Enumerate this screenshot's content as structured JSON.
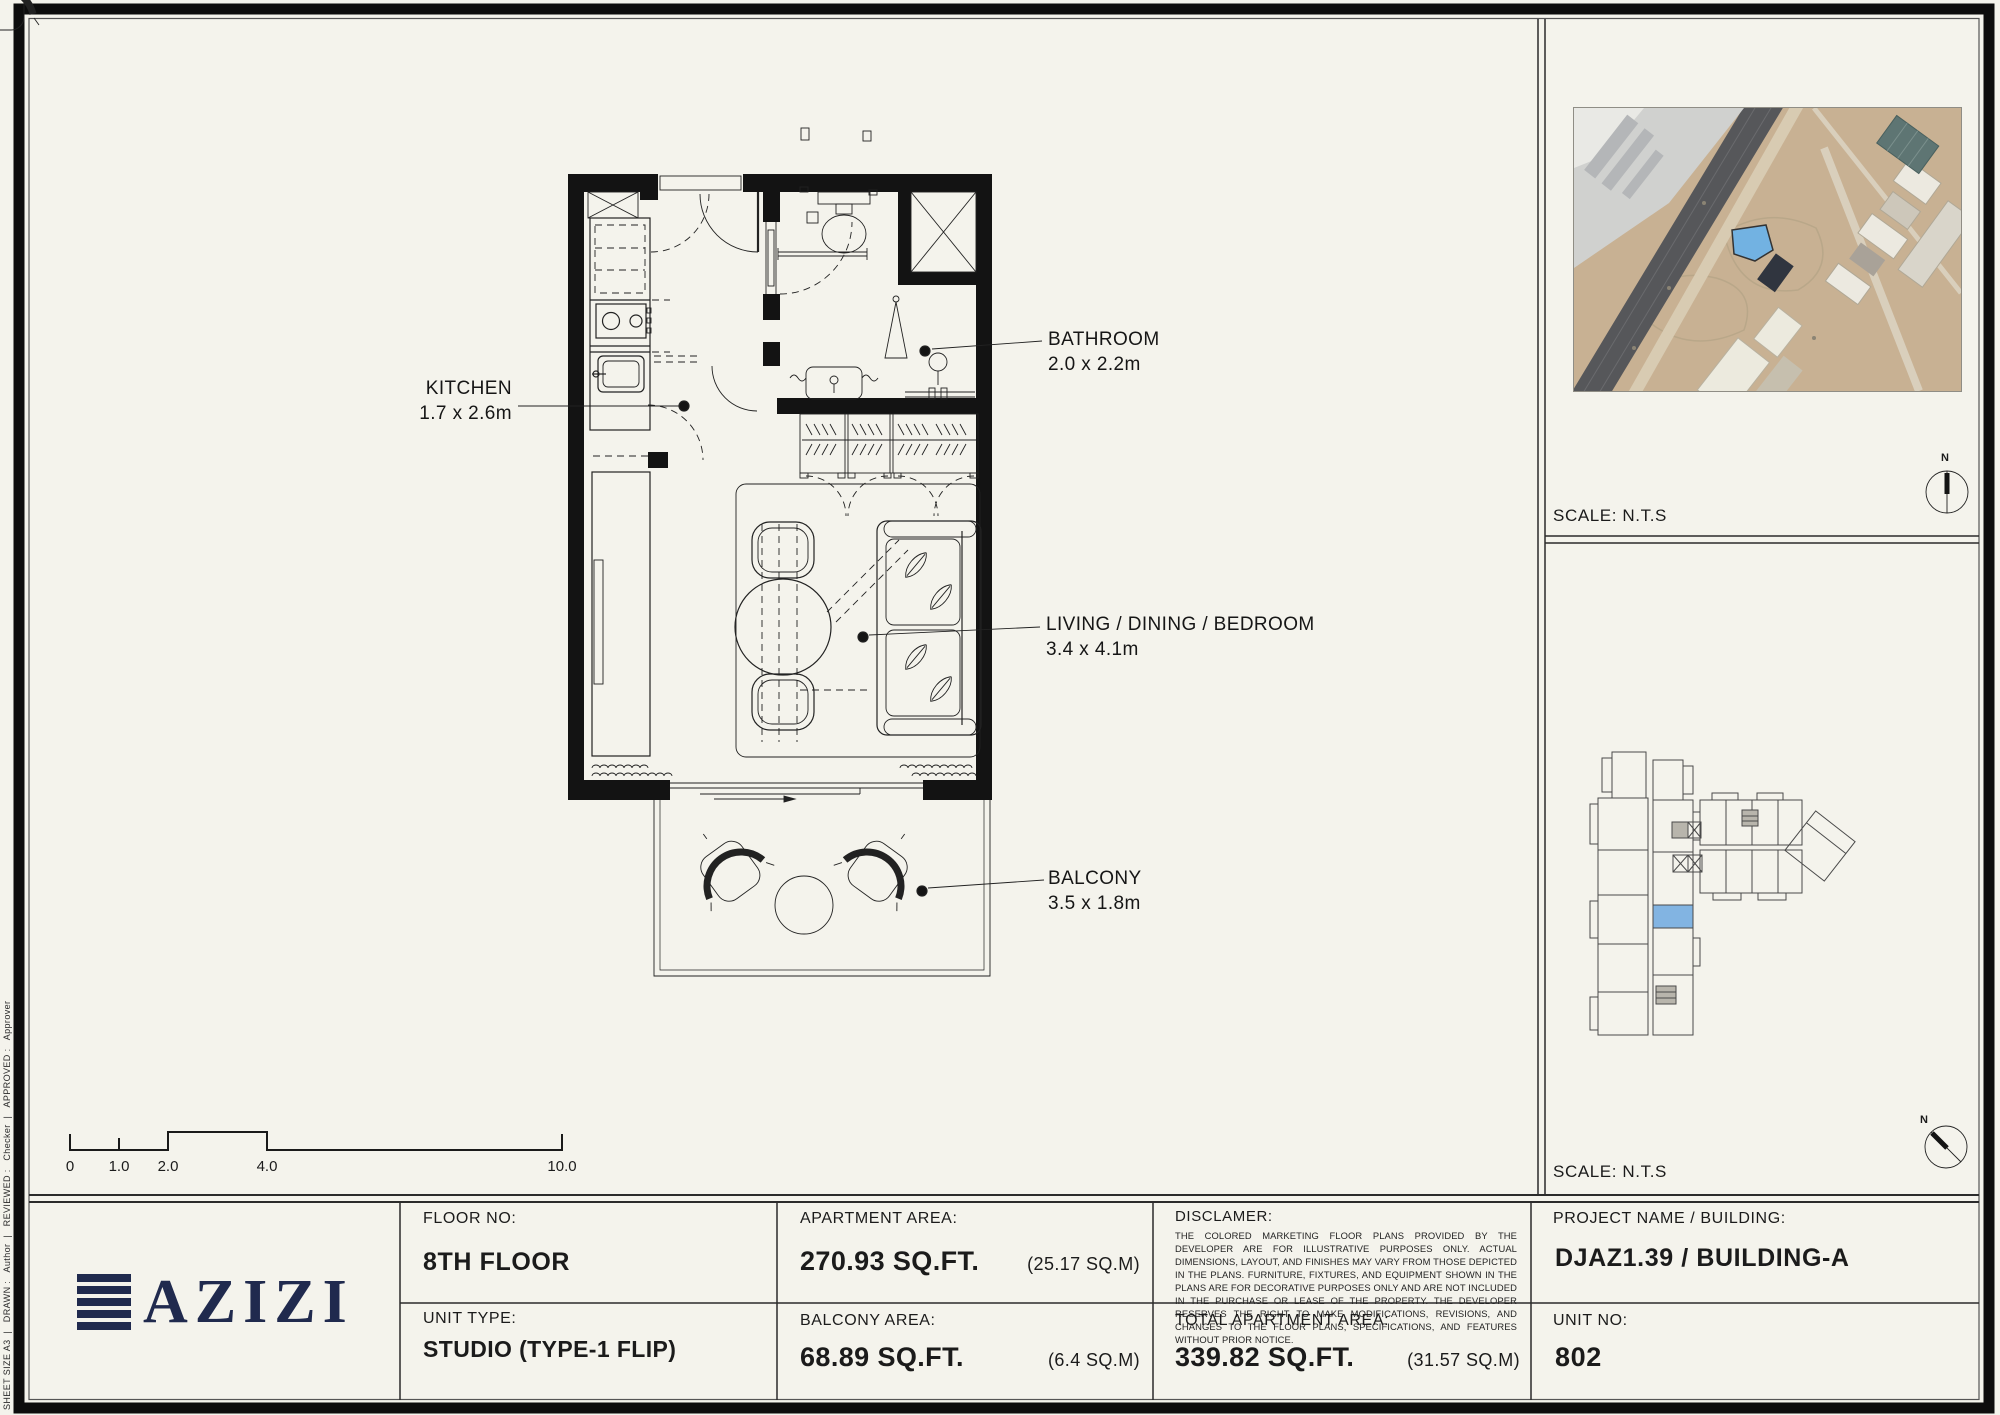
{
  "colors": {
    "paper": "#f4f3ec",
    "ink": "#141414",
    "brand_navy": "#202a4e",
    "unit_highlight_blue": "#82b4e2",
    "site_plot_blue": "#72b2e2"
  },
  "icons": {
    "north_compass": "compass-needle-icon",
    "duct_x": "shaft-x-icon"
  },
  "plan": {
    "rooms": [
      {
        "name": "KITCHEN",
        "dims": "1.7 x 2.6m"
      },
      {
        "name": "BATHROOM",
        "dims": "2.0 x 2.2m"
      },
      {
        "name": "LIVING / DINING / BEDROOM",
        "dims": "3.4 x 4.1m"
      },
      {
        "name": "BALCONY",
        "dims": "3.5 x 1.8m"
      }
    ],
    "scale_bar": {
      "ticks": [
        "0",
        "1.0",
        "2.0",
        "4.0",
        "10.0"
      ]
    }
  },
  "map_panel": {
    "scale_label": "SCALE: N.T.S",
    "north_label": "N"
  },
  "keyplan_panel": {
    "scale_label": "SCALE: N.T.S",
    "north_label": "N"
  },
  "sheet_margin": {
    "sheet_size": "SHEET SIZE A3",
    "drawn_label": "DRAWN :",
    "drawn": "Author",
    "reviewed_label": "REVIEWED :",
    "reviewed": "Checker",
    "approved_label": "APPROVED :",
    "approved": "Approver"
  },
  "title_block": {
    "brand": "AZIZI",
    "floor_label": "FLOOR NO:",
    "floor": "8TH FLOOR",
    "unit_type_label": "UNIT TYPE:",
    "unit_type": "STUDIO (TYPE-1 FLIP)",
    "apartment_area_label": "APARTMENT AREA:",
    "apartment_area": "270.93 SQ.FT.",
    "apartment_area_m": "(25.17 SQ.M)",
    "balcony_area_label": "BALCONY AREA:",
    "balcony_area": "68.89 SQ.FT.",
    "balcony_area_m": "(6.4 SQ.M)",
    "disclaimer_label": "DISCLAMER:",
    "disclaimer": "THE COLORED MARKETING FLOOR PLANS PROVIDED BY THE DEVELOPER ARE FOR ILLUSTRATIVE PURPOSES ONLY. ACTUAL DIMENSIONS, LAYOUT, AND FINISHES MAY VARY FROM THOSE DEPICTED IN THE PLANS. FURNITURE, FIXTURES, AND EQUIPMENT SHOWN IN THE PLANS ARE FOR DECORATIVE PURPOSES ONLY AND ARE NOT INCLUDED IN THE PURCHASE OR LEASE OF THE PROPERTY. THE DEVELOPER RESERVES THE RIGHT TO MAKE MODIFICATIONS, REVISIONS, AND CHANGES TO THE FLOOR PLANS, SPECIFICATIONS, AND FEATURES WITHOUT PRIOR NOTICE.",
    "total_area_label": "TOTAL APARTMENT AREA:",
    "total_area": "339.82 SQ.FT.",
    "total_area_m": "(31.57 SQ.M)",
    "project_label": "PROJECT NAME / BUILDING:",
    "project": "DJAZ1.39 / BUILDING-A",
    "unit_no_label": "UNIT NO:",
    "unit_no": "802"
  }
}
